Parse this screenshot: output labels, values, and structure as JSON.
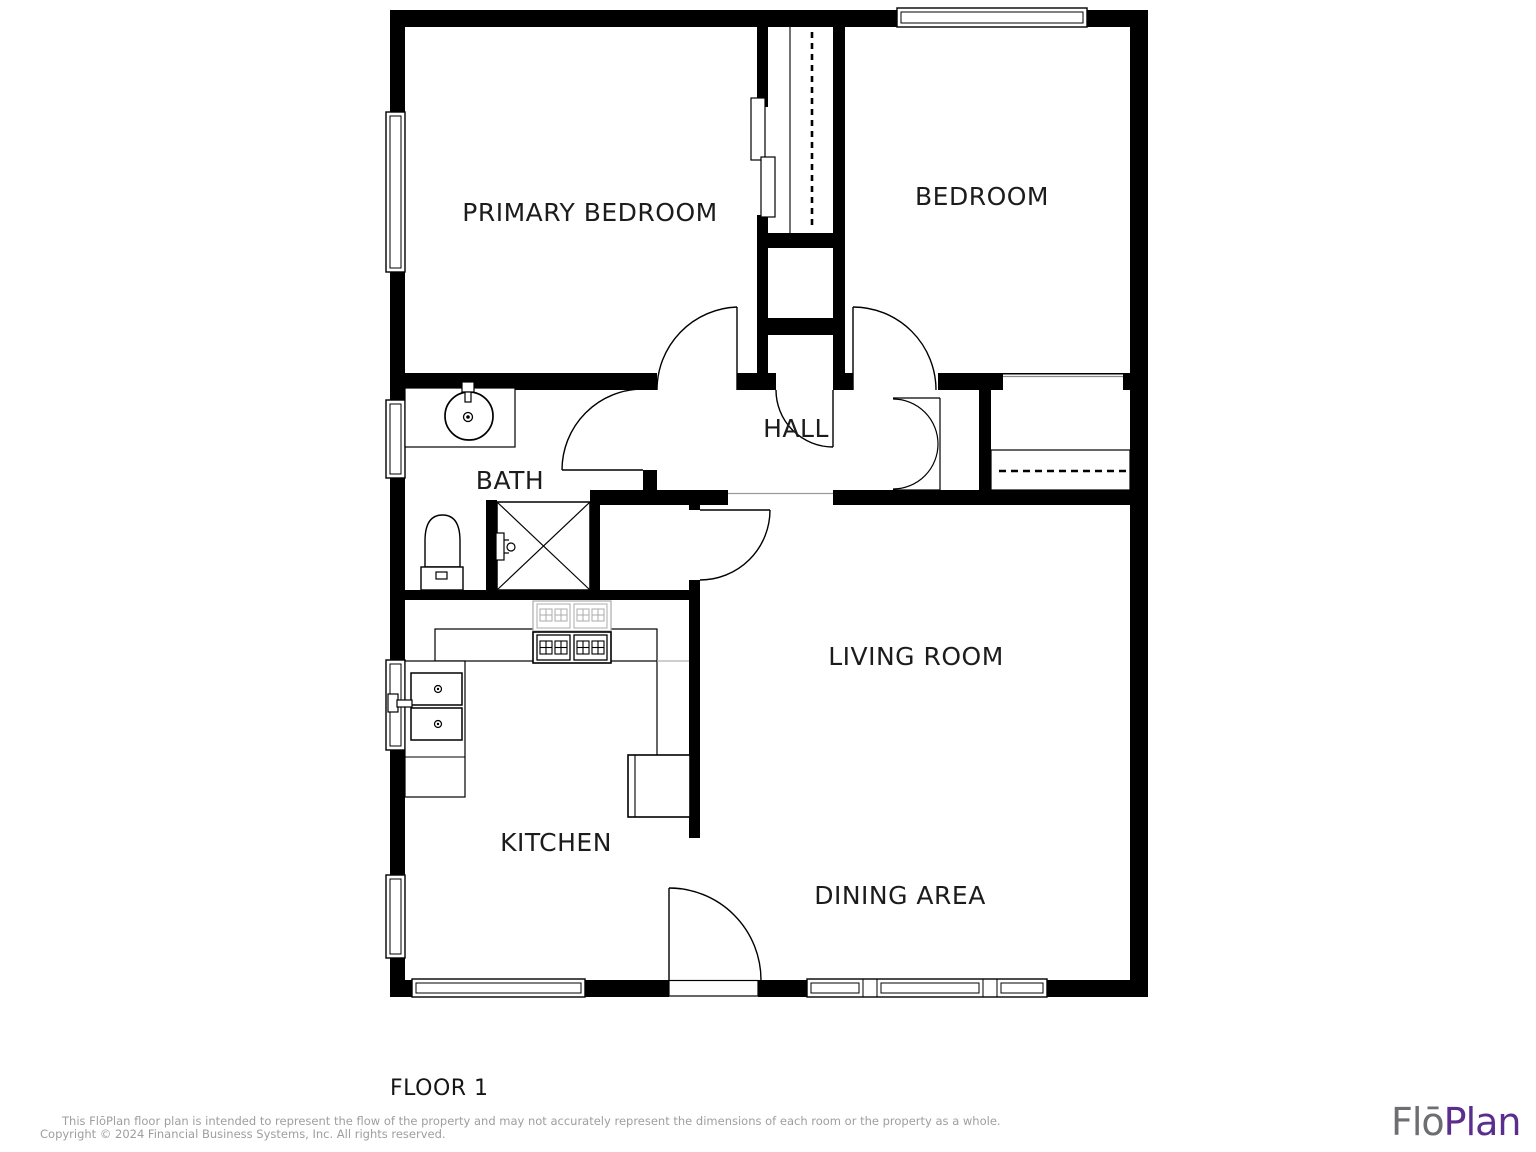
{
  "floor_plan": {
    "rooms": {
      "primary_bedroom": "PRIMARY BEDROOM",
      "bedroom": "BEDROOM",
      "hall": "HALL",
      "bath": "BATH",
      "kitchen": "KITCHEN",
      "living_room": "LIVING ROOM",
      "dining_area": "DINING AREA"
    },
    "floor_label": "FLOOR 1"
  },
  "footer": {
    "disclaimer_line1": "This FlōPlan floor plan is intended to represent the flow of the property and may not accurately represent the dimensions of each room or the property as a whole.",
    "disclaimer_line2": "Copyright © 2024 Financial Business Systems, Inc. All rights reserved.",
    "logo": {
      "part1": "Flō",
      "part2": "Plan"
    }
  },
  "colors": {
    "walls": "#000000",
    "label_text": "#1c1c1c",
    "disclaimer_text": "#9e9e9e",
    "logo_gray": "#6d6e71",
    "logo_purple": "#5b2d8e",
    "ghost_fixture_gray": "#ababab"
  }
}
